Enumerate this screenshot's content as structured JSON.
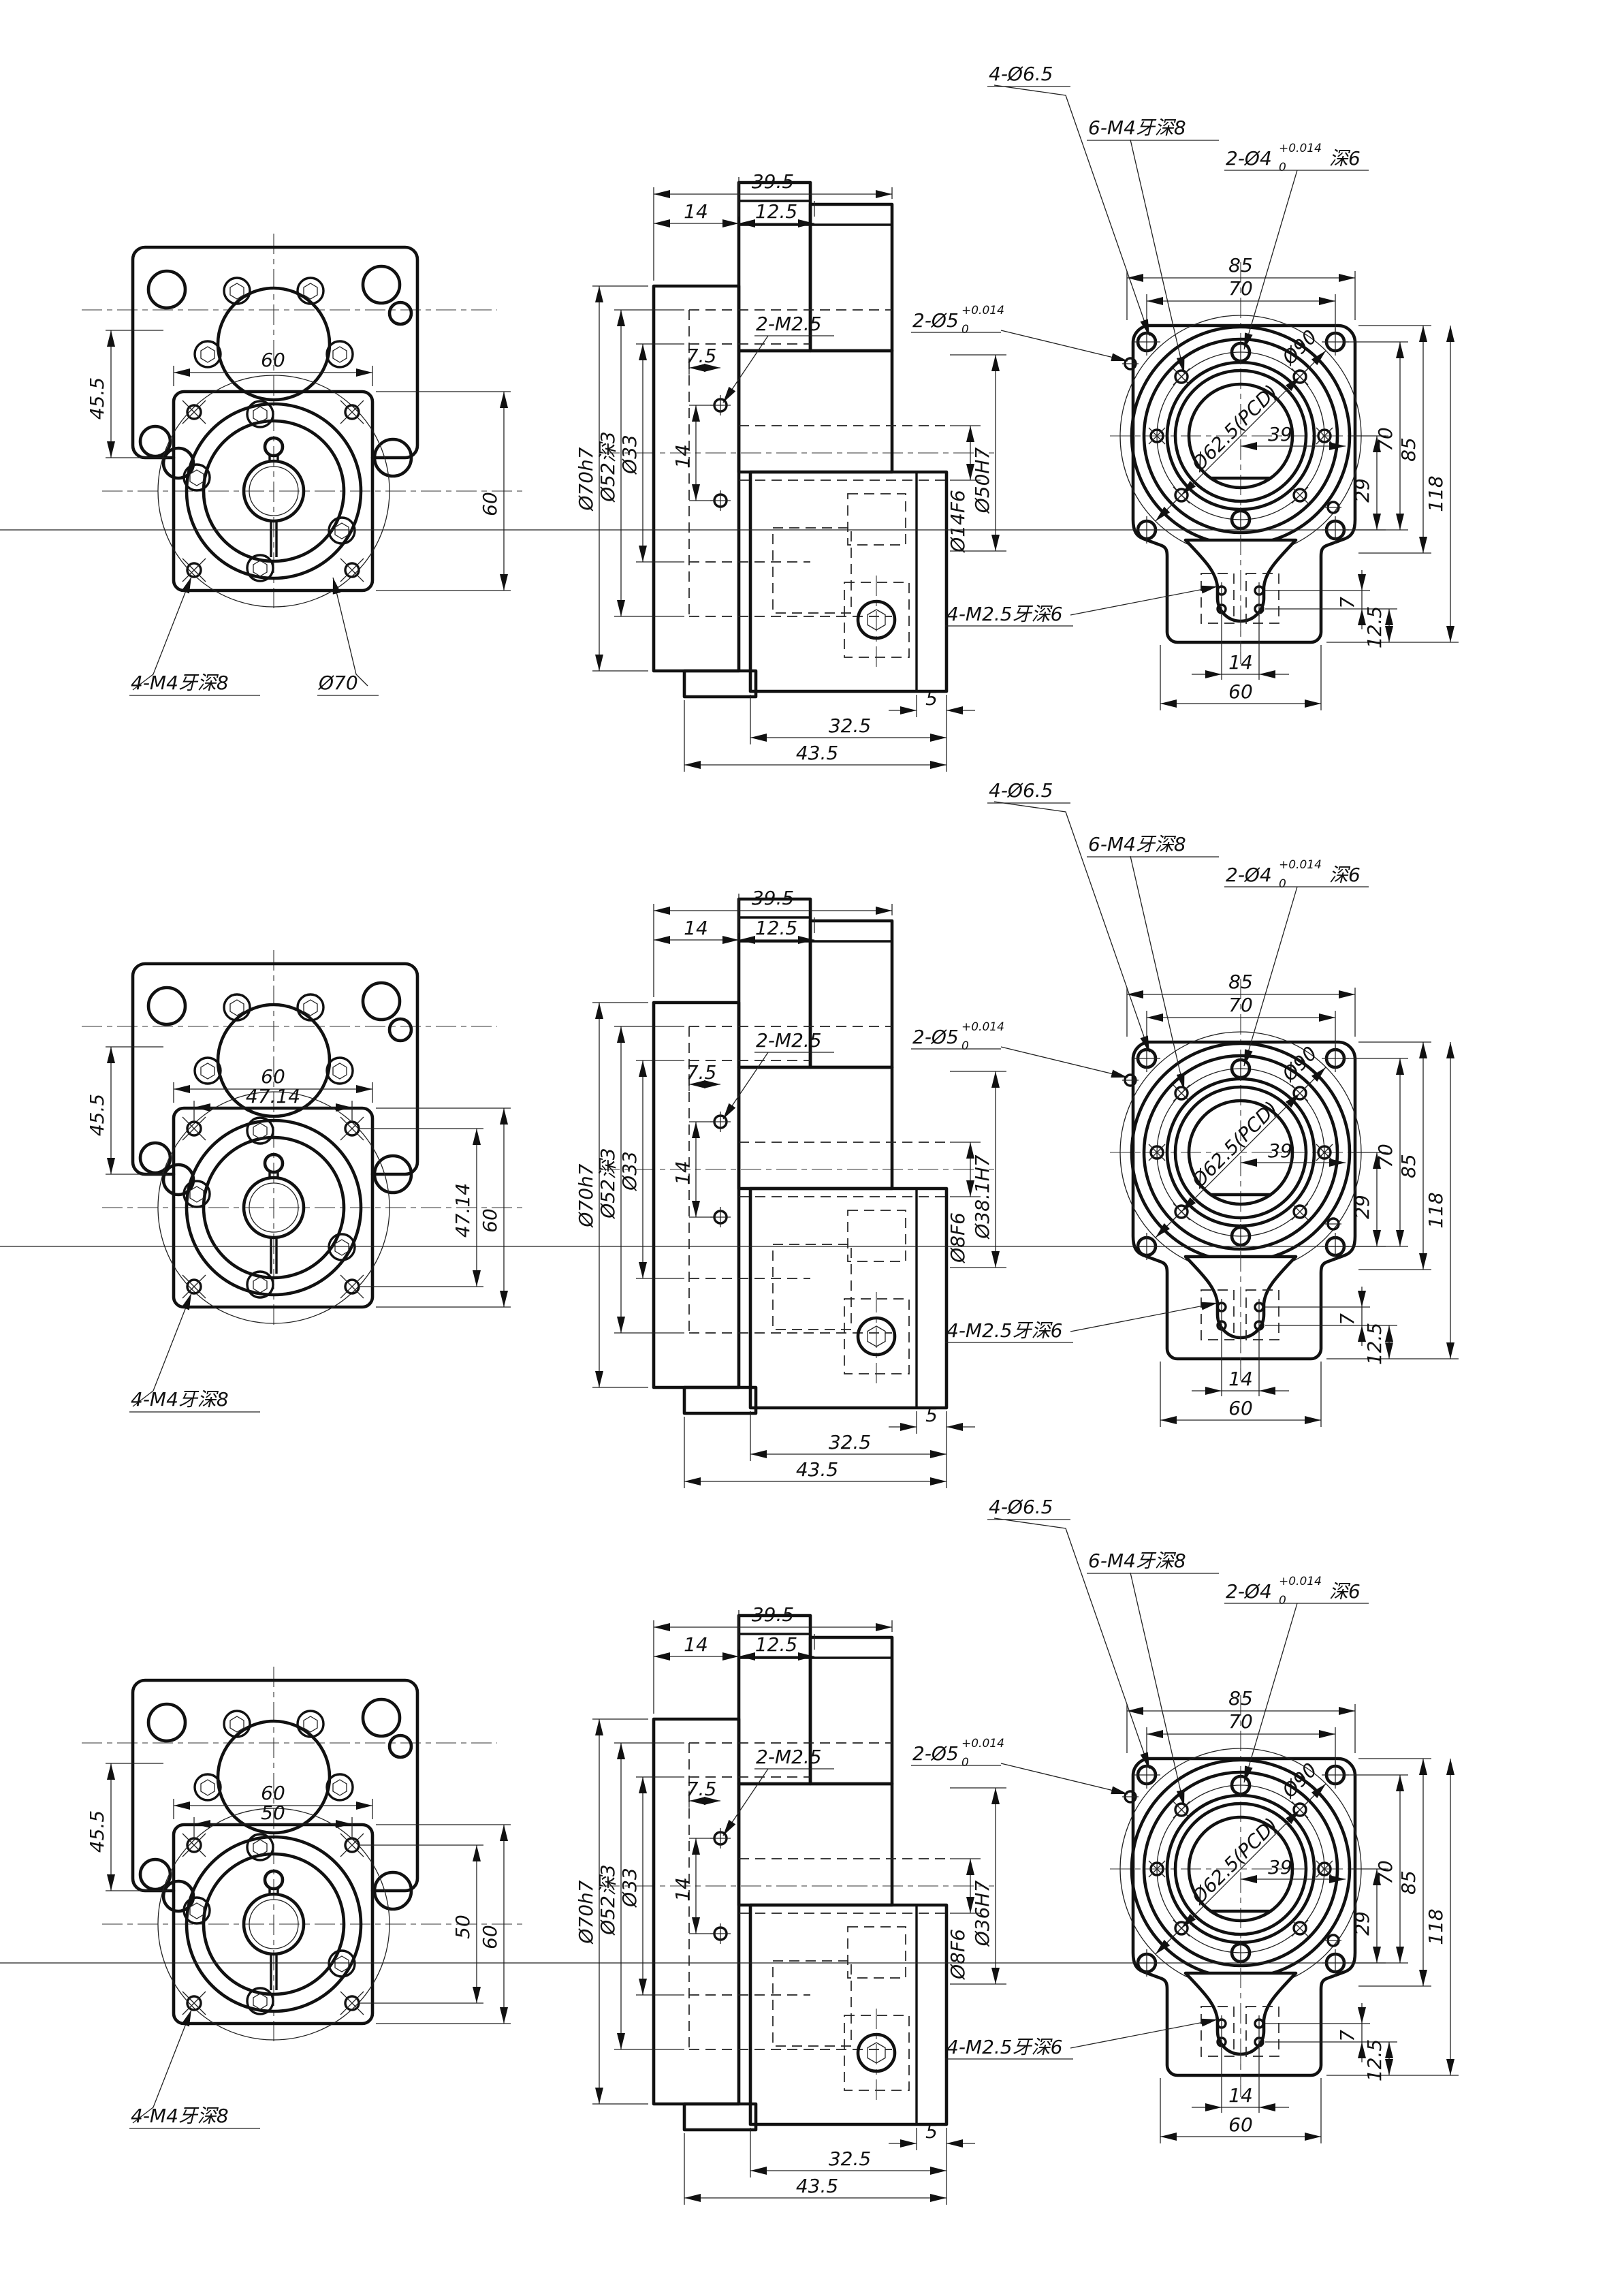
{
  "sheet": {
    "kind": "mechanical engineering drawing, 3 variants of a motor flange adapter, 3 views each"
  },
  "rows": [
    {
      "left": {
        "dim_width_top": "60",
        "dim_width_inner": "",
        "dim_left": "45.5",
        "dim_right_inner": "",
        "dim_right_outer": "60",
        "leader_m4": "4-M4牙深8",
        "leader_dia": "Ø70"
      },
      "middle": {
        "dim_total_w": "39.5",
        "dim_w1": "14",
        "dim_w2": "12.5",
        "dia_outer": "Ø70h7",
        "dia_recess": "Ø52深3",
        "dia_inner": "Ø33",
        "dim_screw_v": "14",
        "dim_screw_h": "7.5",
        "leader_screws": "2-M2.5",
        "dia_shaft": "Ø14F6",
        "dia_bore": "Ø50H7",
        "dim_b5": "5",
        "dim_b325": "32.5",
        "dim_b435": "43.5"
      },
      "right": {
        "leader_65": "4-Ø6.5",
        "leader_m4": "6-M4牙深8",
        "leader_d4": "2-Ø4",
        "d4_tol_top": "+0.014",
        "d4_tol_bot": "0",
        "d4_suffix": "深6",
        "leader_d5": "2-Ø5",
        "d5_tol_top": "+0.014",
        "d5_tol_bot": "0",
        "dim_85_top": "85",
        "dim_70_top": "70",
        "dia_pcd": "Ø62.5(PCD)",
        "dia_90": "Ø90",
        "dim_39": "39",
        "dim_29": "29",
        "dim_70_r": "70",
        "dim_85_r": "85",
        "dim_118": "118",
        "leader_m25": "4-M2.5牙深6",
        "dim_7": "7",
        "dim_125": "12.5",
        "dim_14": "14",
        "dim_60": "60"
      }
    },
    {
      "left": {
        "dim_width_top": "60",
        "dim_width_inner": "47.14",
        "dim_left": "45.5",
        "dim_right_inner": "47.14",
        "dim_right_outer": "60",
        "leader_m4": "4-M4牙深8",
        "leader_dia": ""
      },
      "middle": {
        "dim_total_w": "39.5",
        "dim_w1": "14",
        "dim_w2": "12.5",
        "dia_outer": "Ø70h7",
        "dia_recess": "Ø52深3",
        "dia_inner": "Ø33",
        "dim_screw_v": "14",
        "dim_screw_h": "7.5",
        "leader_screws": "2-M2.5",
        "dia_shaft": "Ø8F6",
        "dia_bore": "Ø38.1H7",
        "dim_b5": "5",
        "dim_b325": "32.5",
        "dim_b435": "43.5"
      },
      "right": {
        "leader_65": "4-Ø6.5",
        "leader_m4": "6-M4牙深8",
        "leader_d4": "2-Ø4",
        "d4_tol_top": "+0.014",
        "d4_tol_bot": "0",
        "d4_suffix": "深6",
        "leader_d5": "2-Ø5",
        "d5_tol_top": "+0.014",
        "d5_tol_bot": "0",
        "dim_85_top": "85",
        "dim_70_top": "70",
        "dia_pcd": "Ø62.5(PCD)",
        "dia_90": "Ø90",
        "dim_39": "39",
        "dim_29": "29",
        "dim_70_r": "70",
        "dim_85_r": "85",
        "dim_118": "118",
        "leader_m25": "4-M2.5牙深6",
        "dim_7": "7",
        "dim_125": "12.5",
        "dim_14": "14",
        "dim_60": "60"
      }
    },
    {
      "left": {
        "dim_width_top": "60",
        "dim_width_inner": "50",
        "dim_left": "45.5",
        "dim_right_inner": "50",
        "dim_right_outer": "60",
        "leader_m4": "4-M4牙深8",
        "leader_dia": ""
      },
      "middle": {
        "dim_total_w": "39.5",
        "dim_w1": "14",
        "dim_w2": "12.5",
        "dia_outer": "Ø70h7",
        "dia_recess": "Ø52深3",
        "dia_inner": "Ø33",
        "dim_screw_v": "14",
        "dim_screw_h": "7.5",
        "leader_screws": "2-M2.5",
        "dia_shaft": "Ø8F6",
        "dia_bore": "Ø36H7",
        "dim_b5": "5",
        "dim_b325": "32.5",
        "dim_b435": "43.5"
      },
      "right": {
        "leader_65": "4-Ø6.5",
        "leader_m4": "6-M4牙深8",
        "leader_d4": "2-Ø4",
        "d4_tol_top": "+0.014",
        "d4_tol_bot": "0",
        "d4_suffix": "深6",
        "leader_d5": "2-Ø5",
        "d5_tol_top": "+0.014",
        "d5_tol_bot": "0",
        "dim_85_top": "85",
        "dim_70_top": "70",
        "dia_pcd": "Ø62.5(PCD)",
        "dia_90": "Ø90",
        "dim_39": "39",
        "dim_29": "29",
        "dim_70_r": "70",
        "dim_85_r": "85",
        "dim_118": "118",
        "leader_m25": "4-M2.5牙深6",
        "dim_7": "7",
        "dim_125": "12.5",
        "dim_14": "14",
        "dim_60": "60"
      }
    }
  ]
}
